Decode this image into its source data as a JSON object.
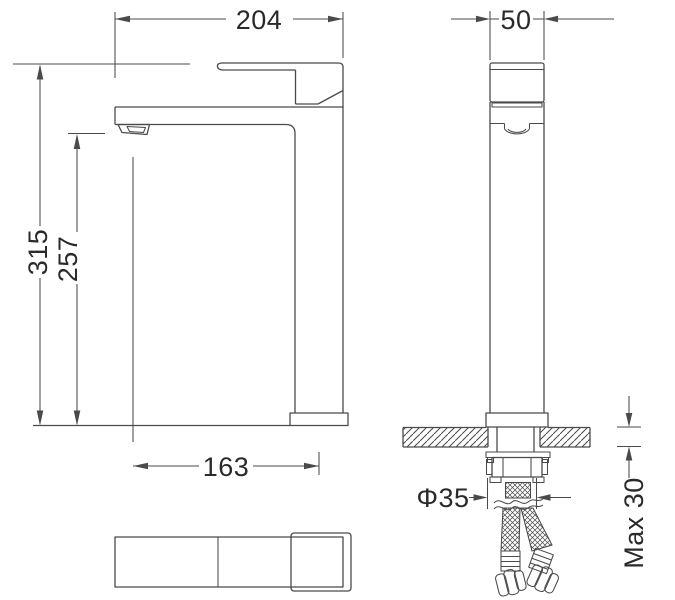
{
  "colors": {
    "background": "#ffffff",
    "line": "#4a4a4a",
    "text": "#2a2a2a"
  },
  "dimensions": {
    "overall_depth": "204",
    "body_width": "50",
    "overall_height": "315",
    "spout_outlet_height": "257",
    "spout_reach": "163",
    "mounting_hole_diameter": "Φ35",
    "max_deck_thickness": "Max 30"
  }
}
